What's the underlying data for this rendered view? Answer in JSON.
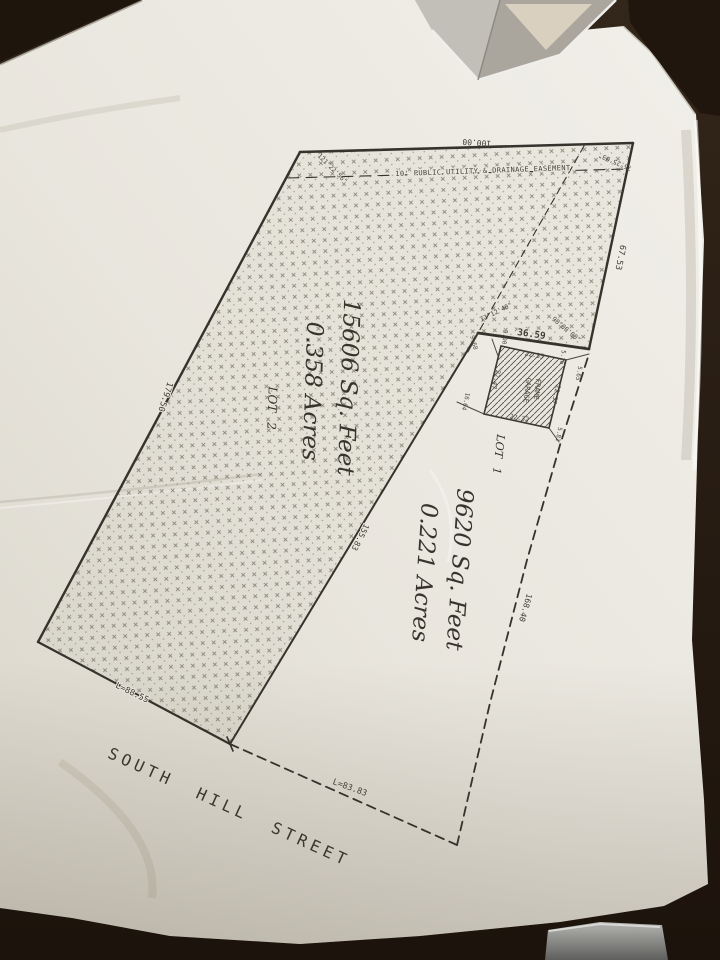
{
  "colors": {
    "table": "#281d12",
    "paper": "#e9e6de",
    "ink": "#3c3931",
    "hatch": "#74705f"
  },
  "plat": {
    "street_name": "SOUTH HILL STREET",
    "easement_label": "10' PUBLIC UTILITY & DRAINAGE EASEMENT",
    "lot2": {
      "name": "LOT 2",
      "area_sqft": "15606 Sq. Feet",
      "area_acres": "0.358 Acres"
    },
    "lot1": {
      "name": "LOT 1",
      "area_sqft": "9620 Sq. Feet",
      "area_acres": "0.221 Acres"
    },
    "garage": {
      "line1": "FRAME",
      "line2": "GARAGE",
      "dim_top": "22.35",
      "dim_right": "22.37",
      "dim_bottom": "22.32",
      "dim_left": "22.47"
    },
    "ties": {
      "t1": "9.68",
      "t2": "3.00",
      "t3": "5.16",
      "t4": "5.65",
      "t5": "5.81",
      "t6": "16.04"
    },
    "dims": {
      "top": "100.00",
      "right_upper": "67.53",
      "jog": "36.59",
      "left": "179.50",
      "interior": "155.83",
      "right_lower": "168.40",
      "curve_left": "L=88.55",
      "curve_right": "L=83.83"
    },
    "angles": {
      "nw": "121°22'56\"",
      "ne": "75°25'03\"",
      "jog_left": "73°12'40\"",
      "jog_right": "90°00'00\""
    }
  }
}
